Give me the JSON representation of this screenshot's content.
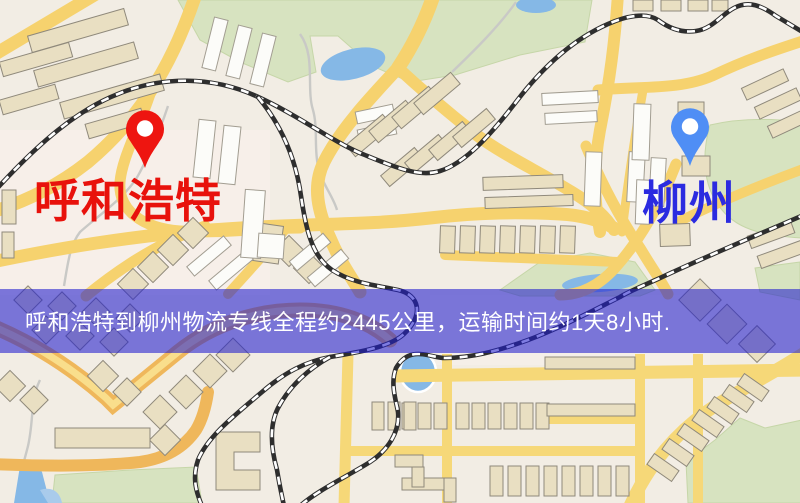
{
  "banner": {
    "text": "呼和浩特到柳州物流专线全程约2445公里，运输时间约1天8小时."
  },
  "markers": {
    "origin": {
      "label": "呼和浩特"
    },
    "destination": {
      "label": "柳州"
    }
  },
  "map": {
    "colors": {
      "background": "#f2ede4",
      "road": "#f6d26e",
      "road_major": "#efb75b",
      "road_grid": "#f6d878",
      "park": "#d7e3c0",
      "water": "#85b8e6",
      "stream": "#c9c9c6",
      "railway": "#2e2e2e",
      "building": "#e9dfc2",
      "building_alt": "#fcfcf9",
      "banner_bg": "rgba(32,30,205,0.58)",
      "banner_text": "#ffffff",
      "origin_text": "#e8120c",
      "destination_text": "#2b2be0",
      "origin_pin": "#ee1510",
      "destination_pin": "#4f8ef5"
    }
  }
}
